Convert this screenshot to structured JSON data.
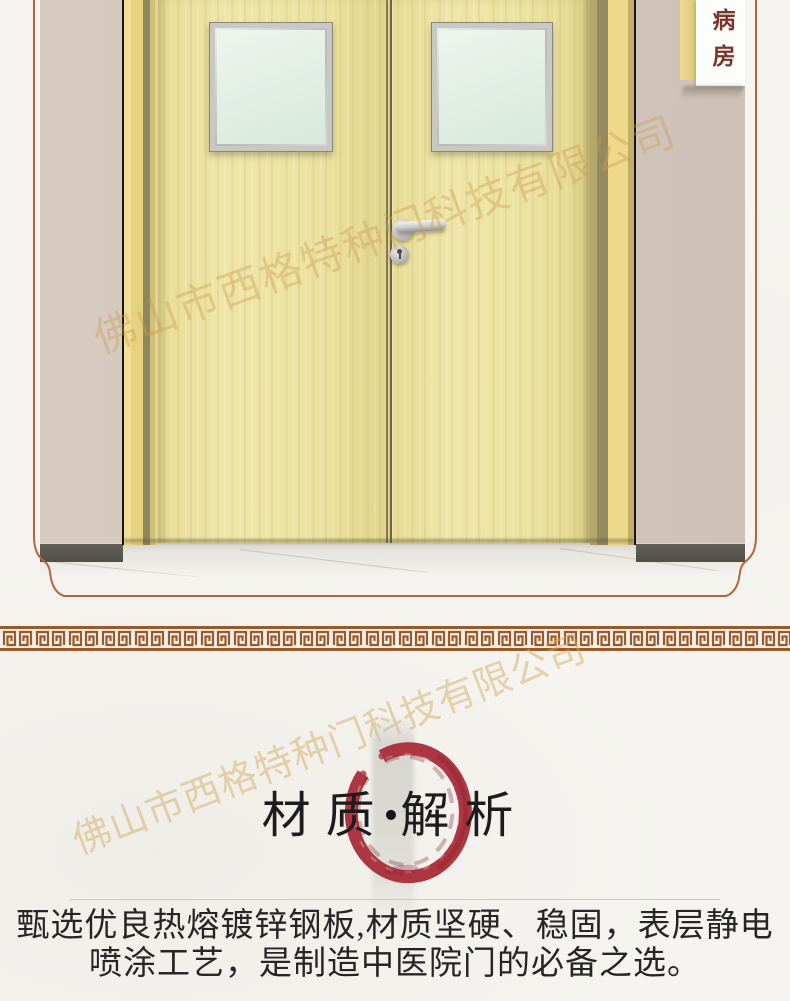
{
  "page": {
    "width": 790,
    "height": 1001,
    "background_color": "#f5f4f0",
    "watermark_text": "佛山市西格特种门科技有限公司"
  },
  "photo": {
    "door_sign_text": "病房",
    "colors": {
      "decorative_frame_border": "#b5643e",
      "wall": "#d4c8bf",
      "door_wood": "#ece2a0",
      "door_frame": "#e9d584",
      "baseboard": "#55534c",
      "floor": "#e7e5e0",
      "glass": "#e3efe6",
      "handle_metal": "#c9c9c7",
      "sign_text_color": "#7a352b"
    }
  },
  "ornament": {
    "meander_color": "#9c5826"
  },
  "section": {
    "title_left": "材质",
    "title_separator": "•",
    "title_right": "解析",
    "enso_color": "#ac3642"
  },
  "body": {
    "line1": "甄选优良热熔镀锌钢板,材质坚硬、稳固，表层静电",
    "line2": "喷涂工艺，是制造中医院门的必备之选。"
  }
}
